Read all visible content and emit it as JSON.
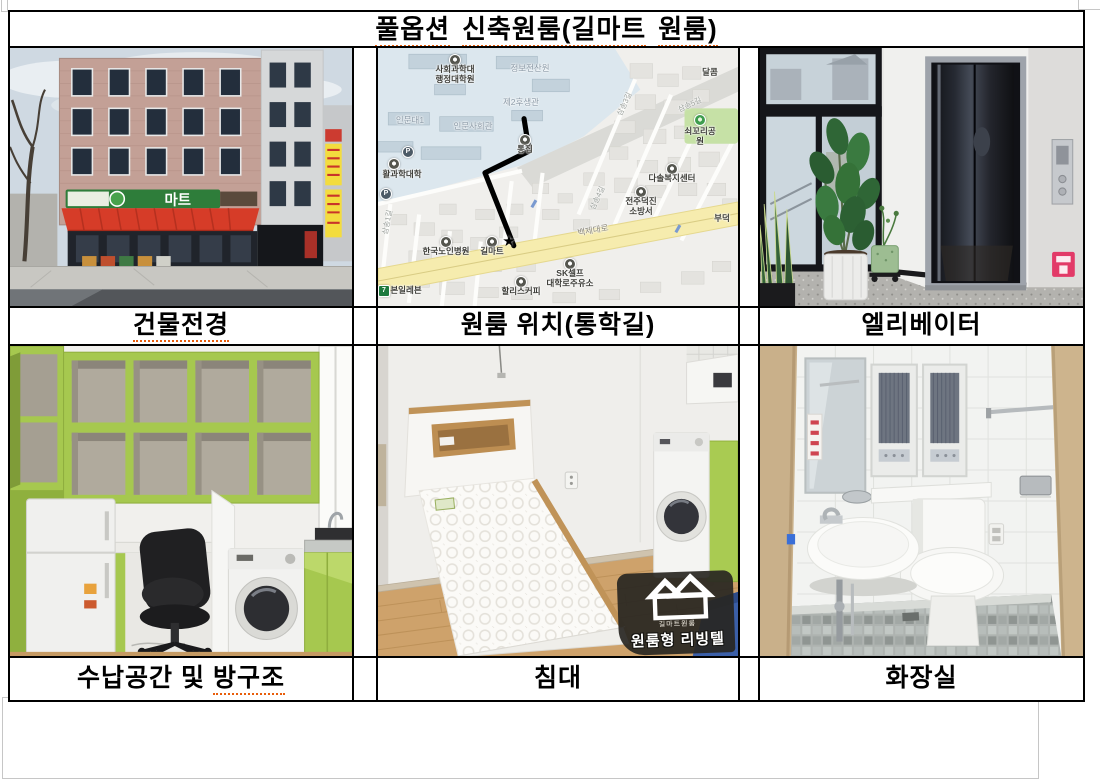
{
  "title_parts": [
    "풀옵션",
    "신축원룸(길마트",
    "원룸)"
  ],
  "captions": {
    "building": "건물전경",
    "map": "원룸 위치(통학길)",
    "elevator": "엘리베이터",
    "storage_plain": "수납공간 및",
    "storage_marked": "방구조",
    "bed": "침대",
    "bathroom": "화장실"
  },
  "building": {
    "sign": "마트"
  },
  "map": {
    "labels": [
      "사회과학대\n행정대학원",
      "정보전산원",
      "제2후생관",
      "달콤",
      "인문대1",
      "인문사회관",
      "통집",
      "쇠꼬리공원",
      "활과학대학",
      "다솔복지센터",
      "전주덕진\n소방서",
      "한국노인병원",
      "길마트",
      "백제대로",
      "SK셀프\n대학로주유소",
      "할리스커피",
      "본일레븐",
      "삼송3길",
      "삼송4길",
      "삼송5길",
      "삼송1길",
      "부덕"
    ],
    "star": "★",
    "parking_glyph": "P",
    "seven_glyph": "7"
  },
  "bed": {
    "watermark_brand": "길마트원룸",
    "watermark_label": "원룸형 리빙텔"
  },
  "colors": {
    "table_border": "#000000",
    "spell_underline": "#e85d0b",
    "map_main_road": "#f6ecae",
    "furniture_green": "#a6c84f",
    "awning_red": "#d63c28"
  }
}
